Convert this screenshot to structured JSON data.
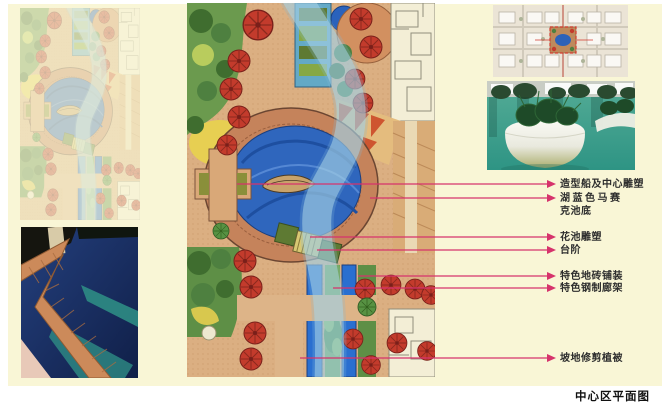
{
  "board": {
    "title": "中心区平面图",
    "panel_background": "#F9F6D6",
    "accent_color": "#D6336C"
  },
  "annotations": [
    {
      "text": "造型船及中心雕塑",
      "text2": ""
    },
    {
      "text": "湖蓝色马赛",
      "text2": "克池底"
    },
    {
      "text": "花池雕塑",
      "text2": ""
    },
    {
      "text": "台阶",
      "text2": ""
    },
    {
      "text": "特色地砖铺装",
      "text2": ""
    },
    {
      "text": "特色钢制廊架",
      "text2": ""
    },
    {
      "text": "坡地修剪植被",
      "text2": ""
    }
  ],
  "colors": {
    "lake_blue": "#2F66BD",
    "ribbon_blue": "#A9D3E6",
    "tree_red": "#C33B2C",
    "tree_green": "#579243",
    "path_tan": "#DBAF82",
    "pool_teal": "#2E8C84",
    "tile_orange": "#CC8A5A"
  }
}
